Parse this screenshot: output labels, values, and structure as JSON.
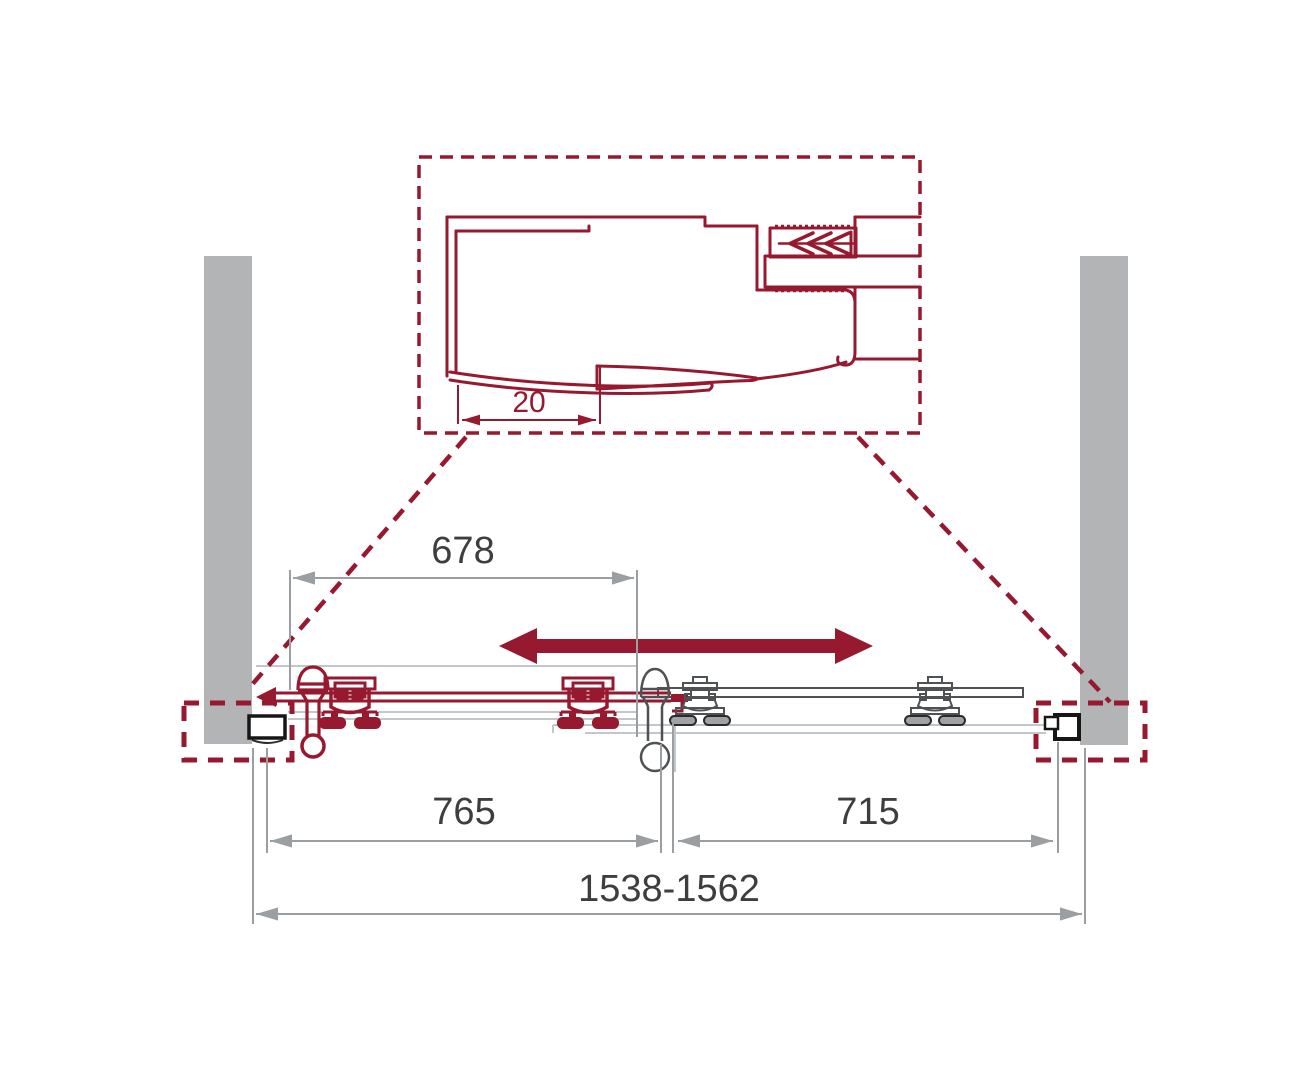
{
  "drawing": {
    "type": "shower-sliding-door-installation-diagram",
    "detail_view": {
      "dimension_gap_label": "20"
    },
    "dimensions": {
      "door_opening_top": "678",
      "sliding_panel_bottom_left": "765",
      "fixed_panel_bottom_right": "715",
      "overall_width_range": "1538-1562"
    },
    "colors": {
      "accent_maroon": "#97192F",
      "wall_gray": "#B2B4B6",
      "profile_black": "#161616",
      "dimension_line_gray": "#9B9FA2",
      "dimension_text": "#3E3E3E",
      "panel_outline_gray": "#4F5254",
      "track_light_gray": "#C4C7C9",
      "background": "#FFFFFF"
    },
    "icons": {
      "slide_direction": "double-headed-arrow",
      "wall_anchor": "chevron-expansion-anchor"
    }
  }
}
